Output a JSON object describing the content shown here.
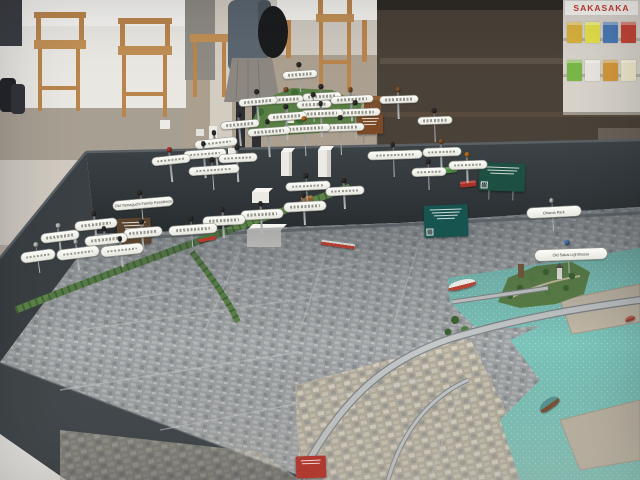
{
  "background": {
    "poster_text": "SAKASAKA",
    "leaflet_colors": [
      "#d8b13c",
      "#e5e04a",
      "#4a79b5",
      "#c24536",
      "#7ab648",
      "#e8e6df",
      "#d3973b",
      "#efe7c9"
    ]
  },
  "table": {
    "frame_color": "#32383c"
  },
  "model": {
    "surface_base_color": "#9ea2a4",
    "water_color": "#7cc4ba",
    "park_color": "#5c8247",
    "landmarks": [
      "old-sakai-lighthouse",
      "harbor-peninsula-park",
      "green-tram-corridor",
      "elevated-expressway"
    ],
    "pins": [
      {
        "x": 300,
        "y": 74,
        "w": 34,
        "h": 7,
        "rot": -4,
        "stem": 10,
        "head": "#2f2c29",
        "label": ""
      },
      {
        "x": 322,
        "y": 96,
        "w": 38,
        "h": 7,
        "rot": -3,
        "stem": 14,
        "head": "#2f2c29",
        "label": ""
      },
      {
        "x": 258,
        "y": 101,
        "w": 38,
        "h": 7,
        "rot": -5,
        "stem": 12,
        "head": "#2f2c29",
        "label": ""
      },
      {
        "x": 287,
        "y": 99,
        "w": 32,
        "h": 7,
        "rot": -3,
        "stem": 10,
        "head": "#7d4f28",
        "label": ""
      },
      {
        "x": 314,
        "y": 104,
        "w": 34,
        "h": 7,
        "rot": -2,
        "stem": 10,
        "head": "#2f2c29",
        "label": ""
      },
      {
        "x": 352,
        "y": 99,
        "w": 42,
        "h": 7,
        "rot": -3,
        "stem": 14,
        "head": "#7d4f28",
        "label": ""
      },
      {
        "x": 287,
        "y": 116,
        "w": 38,
        "h": 7,
        "rot": -4,
        "stem": 16,
        "head": "#2f2c29",
        "label": ""
      },
      {
        "x": 322,
        "y": 113,
        "w": 42,
        "h": 7,
        "rot": -2,
        "stem": 16,
        "head": "#2f2c29",
        "label": ""
      },
      {
        "x": 357,
        "y": 112,
        "w": 46,
        "h": 7,
        "rot": -2,
        "stem": 18,
        "head": "#2f2c29",
        "label": ""
      },
      {
        "x": 240,
        "y": 124,
        "w": 38,
        "h": 7,
        "rot": -5,
        "stem": 14,
        "head": "#2f2c29",
        "label": ""
      },
      {
        "x": 269,
        "y": 131,
        "w": 42,
        "h": 7,
        "rot": -4,
        "stem": 18,
        "head": "#2f2c29",
        "label": ""
      },
      {
        "x": 306,
        "y": 128,
        "w": 48,
        "h": 7,
        "rot": -3,
        "stem": 20,
        "head": "#b2691f",
        "label": ""
      },
      {
        "x": 342,
        "y": 127,
        "w": 44,
        "h": 7,
        "rot": -2,
        "stem": 20,
        "head": "#2f2c29",
        "label": ""
      },
      {
        "x": 216,
        "y": 143,
        "w": 42,
        "h": 8,
        "rot": -6,
        "stem": 16,
        "head": "#2f2c29",
        "label": ""
      },
      {
        "x": 399,
        "y": 99,
        "w": 38,
        "h": 7,
        "rot": -2,
        "stem": 12,
        "head": "#7d4f28",
        "label": ""
      },
      {
        "x": 435,
        "y": 120,
        "w": 34,
        "h": 7,
        "rot": -2,
        "stem": 14,
        "head": "#2f2c29",
        "label": ""
      },
      {
        "x": 171,
        "y": 160,
        "w": 38,
        "h": 8,
        "rot": -6,
        "stem": 14,
        "head": "#a33128",
        "label": ""
      },
      {
        "x": 205,
        "y": 154,
        "w": 42,
        "h": 8,
        "rot": -4,
        "stem": 16,
        "head": "#2f2c29",
        "label": ""
      },
      {
        "x": 238,
        "y": 158,
        "w": 38,
        "h": 8,
        "rot": -3,
        "stem": 16,
        "head": "#2f2c29",
        "label": ""
      },
      {
        "x": 395,
        "y": 155,
        "w": 54,
        "h": 8,
        "rot": -2,
        "stem": 14,
        "head": "#2f2c29",
        "label": ""
      },
      {
        "x": 442,
        "y": 152,
        "w": 38,
        "h": 8,
        "rot": -2,
        "stem": 12,
        "head": "#7d4f28",
        "label": ""
      },
      {
        "x": 429,
        "y": 172,
        "w": 34,
        "h": 8,
        "rot": -2,
        "stem": 10,
        "head": "#2f2c29",
        "label": ""
      },
      {
        "x": 468,
        "y": 165,
        "w": 38,
        "h": 8,
        "rot": -2,
        "stem": 10,
        "head": "#b2691f",
        "label": ""
      },
      {
        "x": 143,
        "y": 203,
        "w": 60,
        "h": 9,
        "rot": -5,
        "stem": 12,
        "head": "#2f2c29",
        "label": "Old Yamaguchi Family Residence"
      },
      {
        "x": 96,
        "y": 224,
        "w": 42,
        "h": 9,
        "rot": -6,
        "stem": 10,
        "head": "#2f2c29",
        "label": ""
      },
      {
        "x": 60,
        "y": 236,
        "w": 38,
        "h": 9,
        "rot": -7,
        "stem": 9,
        "head": "#b5b5b1",
        "label": ""
      },
      {
        "x": 106,
        "y": 239,
        "w": 42,
        "h": 9,
        "rot": -6,
        "stem": 9,
        "head": "#2f2c29",
        "label": ""
      },
      {
        "x": 143,
        "y": 232,
        "w": 38,
        "h": 9,
        "rot": -5,
        "stem": 9,
        "head": "#2f2c29",
        "label": ""
      },
      {
        "x": 38,
        "y": 256,
        "w": 34,
        "h": 10,
        "rot": -8,
        "stem": 8,
        "head": "#b5b5b1",
        "label": ""
      },
      {
        "x": 78,
        "y": 253,
        "w": 42,
        "h": 10,
        "rot": -7,
        "stem": 8,
        "head": "#b5b5b1",
        "label": ""
      },
      {
        "x": 122,
        "y": 250,
        "w": 42,
        "h": 10,
        "rot": -6,
        "stem": 8,
        "head": "#2f2c29",
        "label": ""
      },
      {
        "x": 193,
        "y": 229,
        "w": 48,
        "h": 9,
        "rot": -4,
        "stem": 9,
        "head": "#2f2c29",
        "label": ""
      },
      {
        "x": 224,
        "y": 220,
        "w": 42,
        "h": 9,
        "rot": -3,
        "stem": 9,
        "head": "#2f2c29",
        "label": ""
      },
      {
        "x": 262,
        "y": 214,
        "w": 42,
        "h": 9,
        "rot": -3,
        "stem": 10,
        "head": "#2f2c29",
        "label": ""
      },
      {
        "x": 305,
        "y": 206,
        "w": 42,
        "h": 9,
        "rot": -3,
        "stem": 10,
        "head": "#2f2c29",
        "label": ""
      },
      {
        "x": 308,
        "y": 186,
        "w": 44,
        "h": 8,
        "rot": -3,
        "stem": 10,
        "head": "#2f2c29",
        "label": ""
      },
      {
        "x": 345,
        "y": 191,
        "w": 38,
        "h": 8,
        "rot": -3,
        "stem": 10,
        "head": "#2f2c29",
        "label": ""
      },
      {
        "x": 214,
        "y": 170,
        "w": 50,
        "h": 8,
        "rot": -4,
        "stem": 12,
        "head": "#2f2c29",
        "label": ""
      },
      {
        "x": 554,
        "y": 212,
        "w": 54,
        "h": 10,
        "rot": -3,
        "stem": 10,
        "head": "#b5b5b1",
        "label": "Ohama Park"
      },
      {
        "x": 571,
        "y": 254,
        "w": 72,
        "h": 11,
        "rot": -2,
        "stem": 9,
        "head": "#3e6da8",
        "label": "Old Sakai Lighthouse"
      }
    ],
    "signs": [
      {
        "x": 134,
        "y": 231,
        "w": 34,
        "h": 26,
        "rot": -2,
        "color": "#5a442f",
        "lines": 4,
        "qr": false
      },
      {
        "x": 370,
        "y": 124,
        "w": 26,
        "h": 20,
        "rot": -1,
        "color": "#7c4a26",
        "lines": 3,
        "qr": false
      },
      {
        "x": 502,
        "y": 177,
        "w": 46,
        "h": 28,
        "rot": 2,
        "color": "#1e4f43",
        "lines": 3,
        "qr": true
      },
      {
        "x": 446,
        "y": 221,
        "w": 44,
        "h": 32,
        "rot": -2,
        "color": "#175450",
        "lines": 4,
        "qr": true
      },
      {
        "x": 311,
        "y": 467,
        "w": 30,
        "h": 22,
        "rot": -2,
        "color": "#b03a30",
        "lines": 2,
        "qr": false
      }
    ],
    "vehicles": [
      {
        "name": "tram",
        "x": 207,
        "y": 238,
        "w": 18,
        "h": 6,
        "rot": -12,
        "color": "#b8382f",
        "color2": "#3f7a3c"
      },
      {
        "name": "tram",
        "x": 449,
        "y": 170,
        "w": 16,
        "h": 6,
        "rot": -8,
        "color": "#4d8a44",
        "color2": "#6fae62"
      },
      {
        "name": "tram",
        "x": 468,
        "y": 184,
        "w": 16,
        "h": 6,
        "rot": -6,
        "color": "#a8322b",
        "color2": "#c4544a"
      },
      {
        "name": "bus",
        "x": 307,
        "y": 199,
        "w": 12,
        "h": 6,
        "rot": -8,
        "color": "#8a5a2c",
        "color2": "#a87840"
      },
      {
        "name": "red-bridge",
        "x": 338,
        "y": 244,
        "w": 34,
        "h": 5,
        "rot": 8,
        "color": "#b23c30",
        "color2": "#d0d0cc"
      }
    ],
    "boats": [
      {
        "name": "ferry",
        "x": 462,
        "y": 284,
        "w": 28,
        "h": 9,
        "rot": -14,
        "color": "#e9e7e3",
        "color2": "#b54434"
      },
      {
        "name": "tugboat",
        "x": 549,
        "y": 404,
        "w": 22,
        "h": 10,
        "rot": -35,
        "color": "#55908d",
        "color2": "#7a5034"
      },
      {
        "name": "boat",
        "x": 630,
        "y": 318,
        "w": 10,
        "h": 5,
        "rot": -20,
        "color": "#a05a4a",
        "color2": "#8a3b2e"
      }
    ]
  }
}
